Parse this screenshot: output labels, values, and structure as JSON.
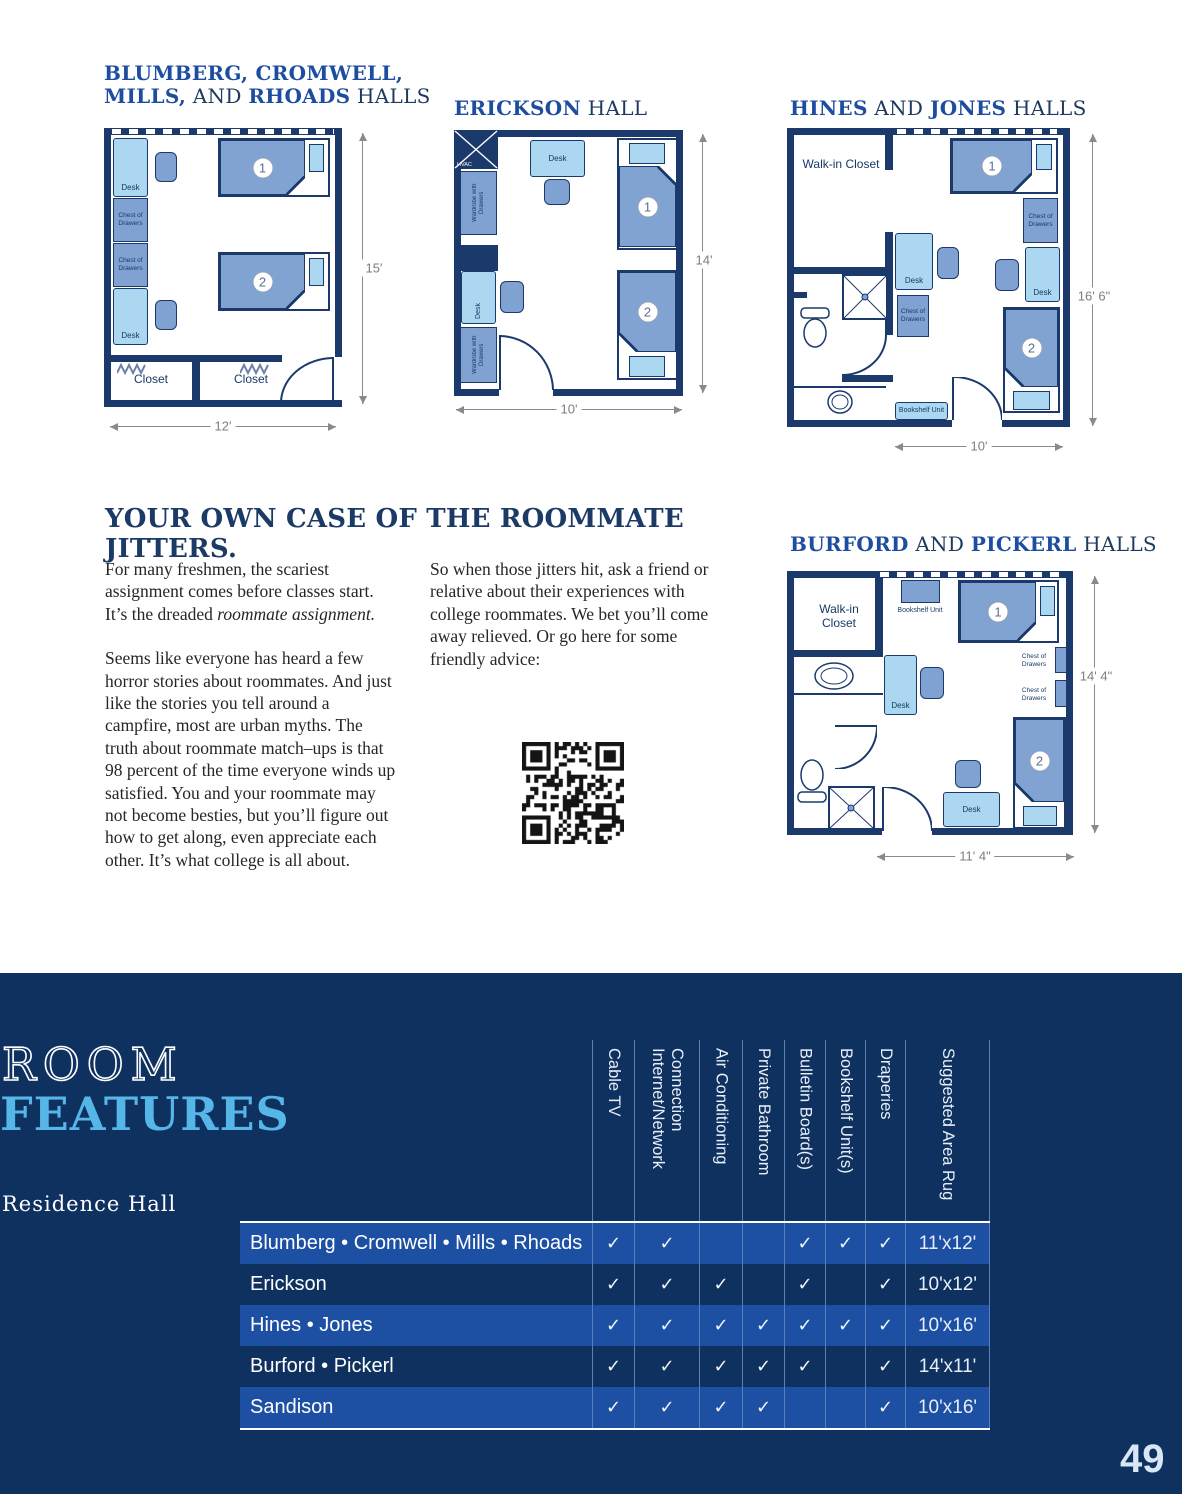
{
  "plans": {
    "p1": {
      "title_line1": "BLUMBERG, CROMWELL,",
      "title_b2": "MILLS,",
      "title_r2a": " AND ",
      "title_b2b": "RHOADS",
      "title_r2b": " HALLS",
      "dim_h": "15'",
      "dim_w": "12'"
    },
    "p2": {
      "title_b": "ERICKSON",
      "title_r": " HALL",
      "dim_h": "14'",
      "dim_w": "10'"
    },
    "p3": {
      "title_b1": "HINES",
      "title_r1": " AND ",
      "title_b2": "JONES",
      "title_r2": " HALLS",
      "dim_h": "16' 6\"",
      "dim_w": "10'"
    },
    "p4": {
      "title_b1": "BURFORD",
      "title_r1": " AND ",
      "title_b2": "PICKERL",
      "title_r2": " HALLS",
      "dim_h": "14' 4\"",
      "dim_w": "11' 4\""
    }
  },
  "labels": {
    "desk": "Desk",
    "chest": "Chest of Drawers",
    "closet": "Closet",
    "walkin": "Walk-in Closet",
    "bookshelf": "Bookshelf Unit",
    "wardrobe": "Wardrobe with Drawers",
    "hvac": "HVAC",
    "bed1": "1",
    "bed2": "2"
  },
  "article": {
    "heading": "YOUR OWN CASE OF THE ROOMMATE JITTERS.",
    "p1": "For many freshmen, the scariest assignment comes before classes start. It’s the dreaded ",
    "p1_italic": "roommate assignment.",
    "p2": "Seems like everyone has heard a few horror stories about roommates. And just like the stories you tell around a campfire, most are urban myths. The truth about roommate match–ups is that 98 percent of the time everyone winds up satisfied. You and your roommate may not become besties, but you’ll figure out how to get along, even appreciate each other. It’s what college is all about.",
    "p3": "So when those jitters hit, ask a friend or relative about their experiences with college roommates. We bet you’ll come away relieved. Or go here for some friendly advice:"
  },
  "table": {
    "title_top": "ROOM",
    "title_bottom": "FEATURES",
    "row_header": "Residence Hall",
    "features": [
      "Cable TV",
      "Internet/Network Connection",
      "Air Conditioning",
      "Private Bathroom",
      "Bulletin Board(s)",
      "Bookshelf Unit(s)",
      "Draperies",
      "Suggested Area Rug"
    ],
    "rows": [
      {
        "hall": "Blumberg • Cromwell • Mills • Rhoads",
        "checks": [
          "✓",
          "✓",
          "",
          "",
          "✓",
          "✓",
          "✓"
        ],
        "rug": "11'x12'"
      },
      {
        "hall": "Erickson",
        "checks": [
          "✓",
          "✓",
          "✓",
          "",
          "✓",
          "",
          "✓"
        ],
        "rug": "10'x12'"
      },
      {
        "hall": "Hines • Jones",
        "checks": [
          "✓",
          "✓",
          "✓",
          "✓",
          "✓",
          "✓",
          "✓"
        ],
        "rug": "10'x16'"
      },
      {
        "hall": "Burford • Pickerl",
        "checks": [
          "✓",
          "✓",
          "✓",
          "✓",
          "✓",
          "",
          "✓"
        ],
        "rug": "14'x11'"
      },
      {
        "hall": "Sandison",
        "checks": [
          "✓",
          "✓",
          "✓",
          "✓",
          "",
          "",
          "✓"
        ],
        "rug": "10'x16'"
      }
    ]
  },
  "page_number": "49",
  "colors": {
    "accent_blue": "#1d4da0",
    "navy": "#1b3a66",
    "band": "#0e3160",
    "row_blue": "#1d50a3",
    "features_cyan": "#56b6e8",
    "wall": "#1b3a6b",
    "furniture_light": "#abd7f0",
    "furniture_medium": "#7fa2d2"
  }
}
